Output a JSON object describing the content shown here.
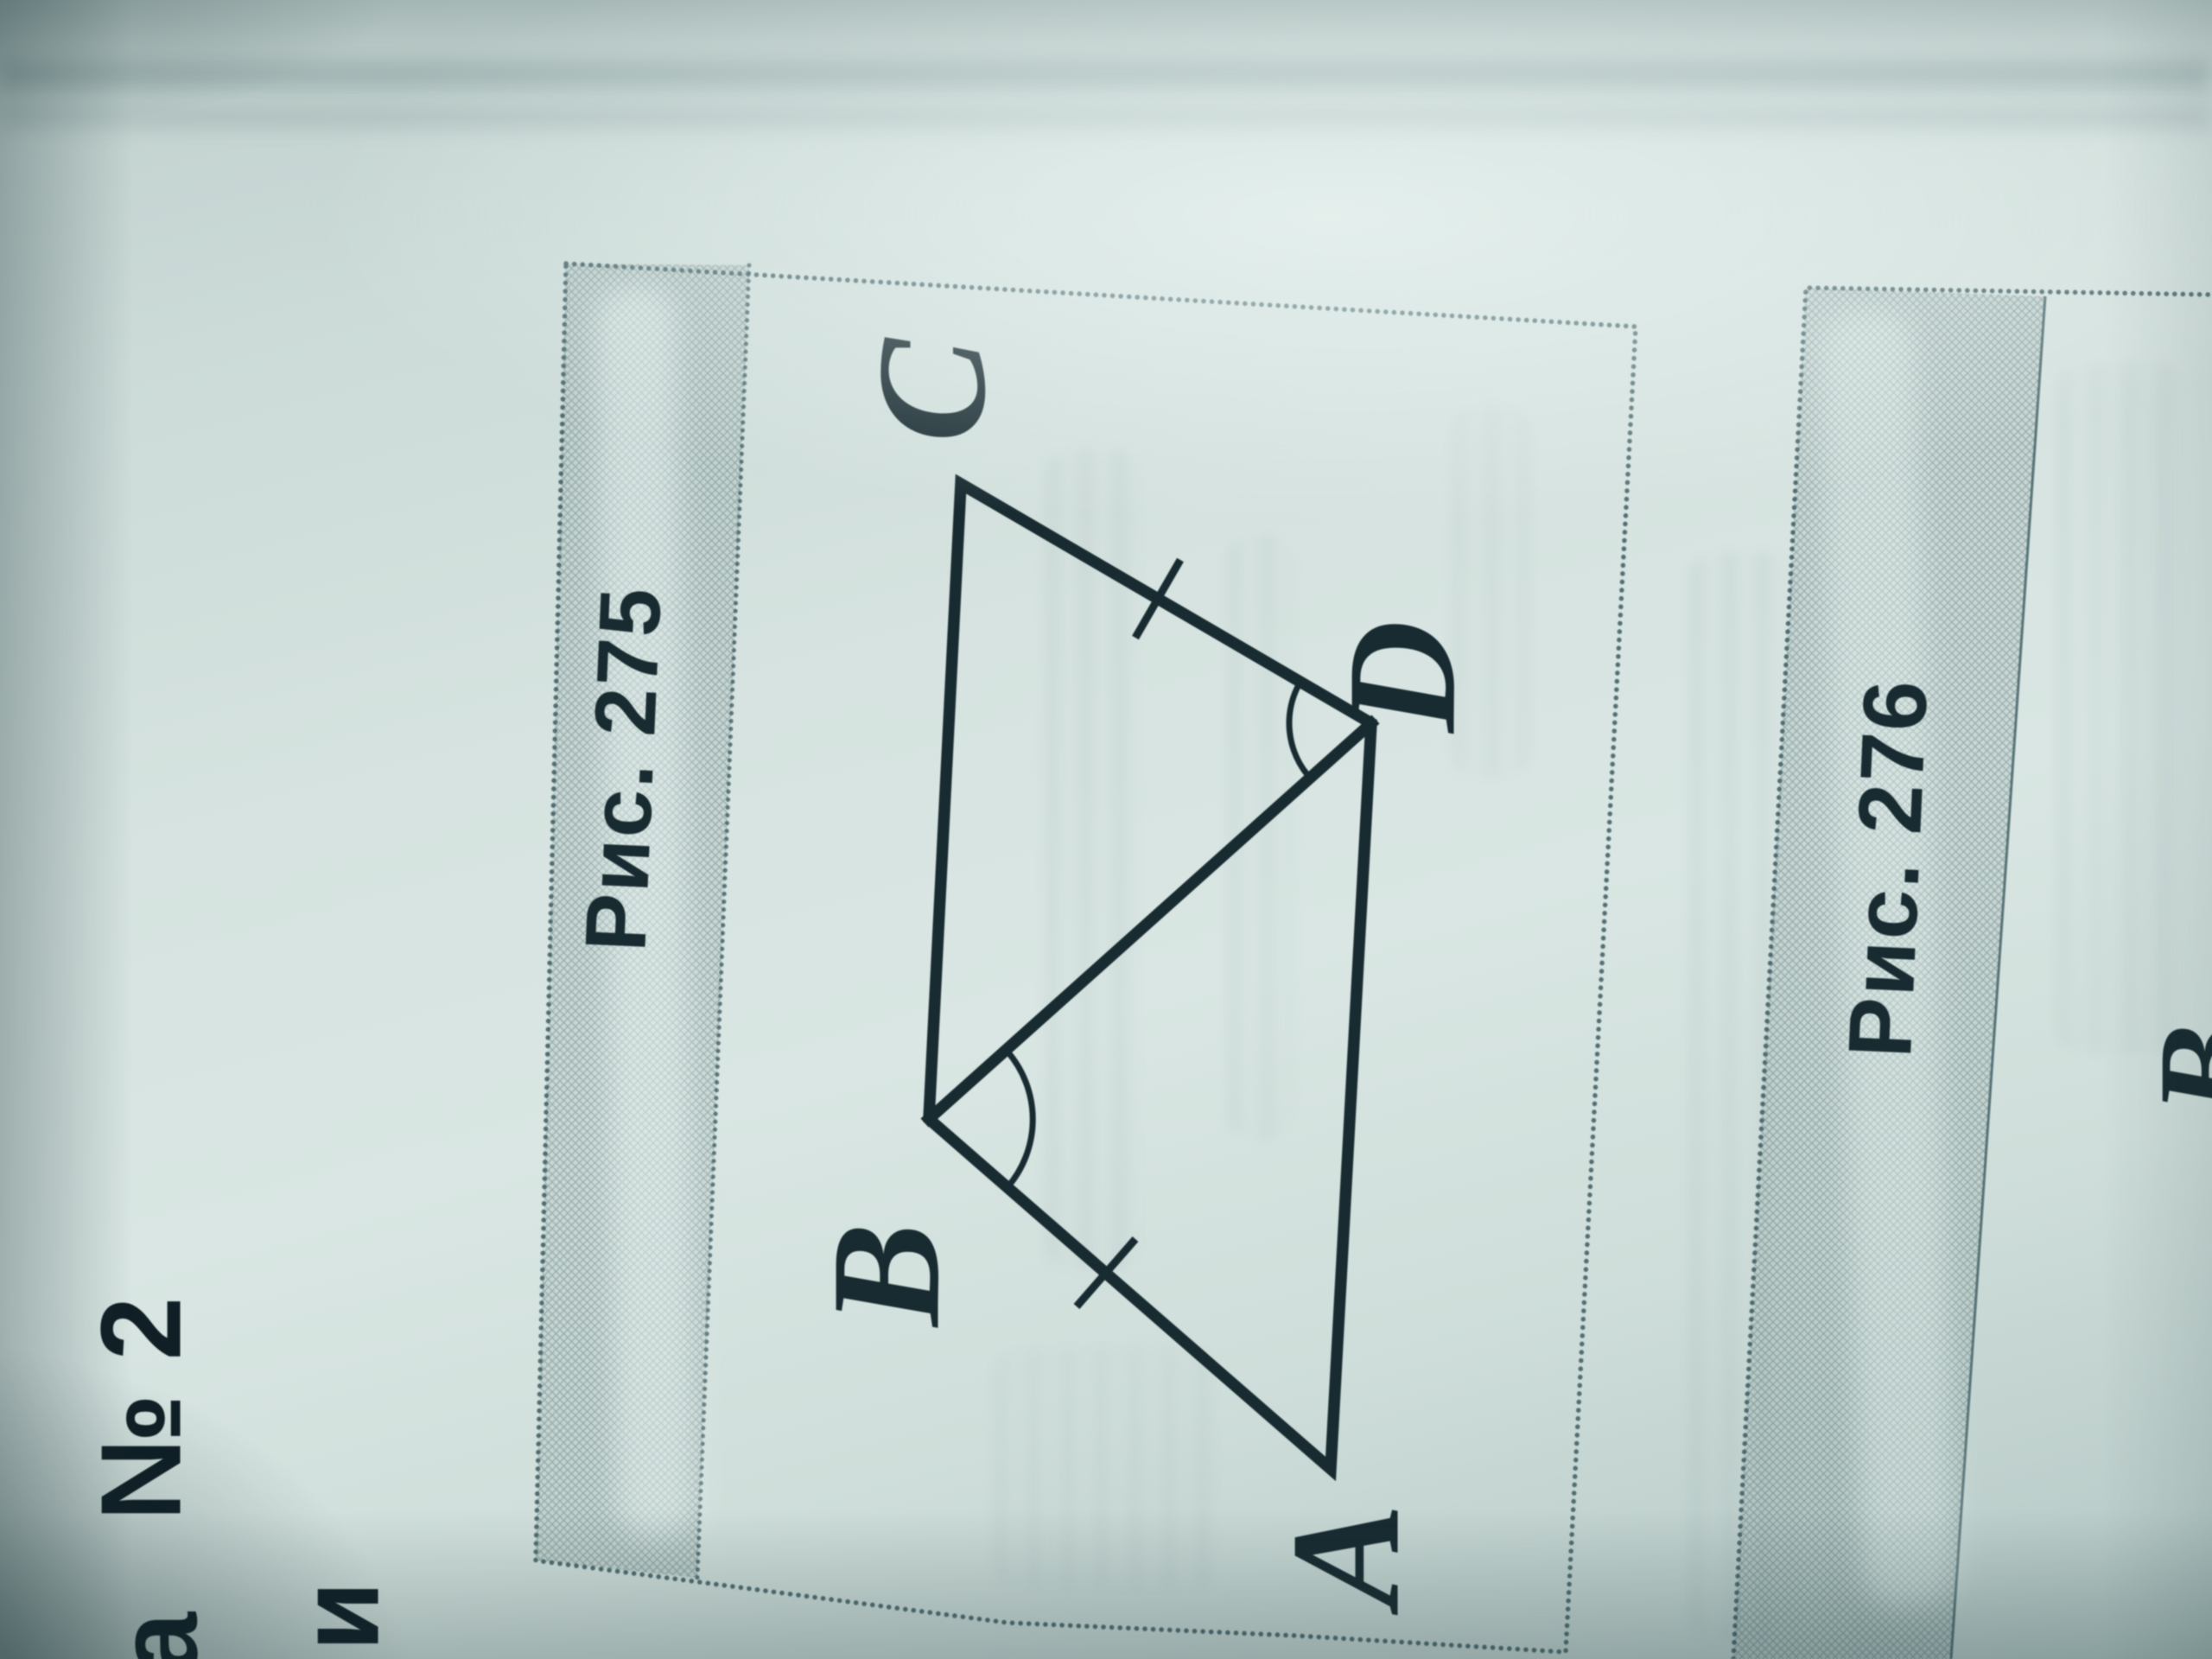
{
  "page": {
    "description": "Photograph of a printed geometry workbook page, page content rotated 90 degrees counter-clockwise in the photo",
    "margin": {
      "word_end_partial": "а",
      "number_label": "№ 2",
      "next_line_partial": "и"
    }
  },
  "figure_275": {
    "caption": "Рис. 275",
    "shape": "quadrilateral ABCD with diagonal BD",
    "vertex_labels": {
      "A": "A",
      "B": "B",
      "C": "C",
      "D": "D"
    },
    "vertices": {
      "A": [
        1540,
        1700
      ],
      "B": [
        1075,
        1295
      ],
      "C": [
        1112,
        560
      ],
      "D": [
        1587,
        837
      ]
    },
    "edges": [
      [
        "C",
        "D"
      ],
      [
        "D",
        "A"
      ],
      [
        "A",
        "B"
      ],
      [
        "B",
        "C"
      ]
    ],
    "diagonal": [
      "B",
      "D"
    ],
    "equal_ticks_on_sides": [
      "CD",
      "AB"
    ],
    "tick_paths": [
      "M 1366 648 L 1314 738",
      "M 1314 1434 L 1246 1512"
    ],
    "angle_marks_at": [
      "D (angle CDB)",
      "B (angle DBA)"
    ],
    "arc_paths": [
      "M 1505 789 A 95 95 0 0 0 1516 900",
      "M 1166 1217 A 120 120 0 0 1 1166 1374"
    ]
  },
  "figure_276": {
    "caption": "Рис. 276",
    "partial_vertex_label": "B"
  },
  "colors": {
    "ink": "#182b31",
    "ink_dark": "#101f26",
    "border_dots": "#3c5a60",
    "page_light": "#d9e6e3",
    "band_tint": "rgba(115,140,143,0.15)"
  }
}
